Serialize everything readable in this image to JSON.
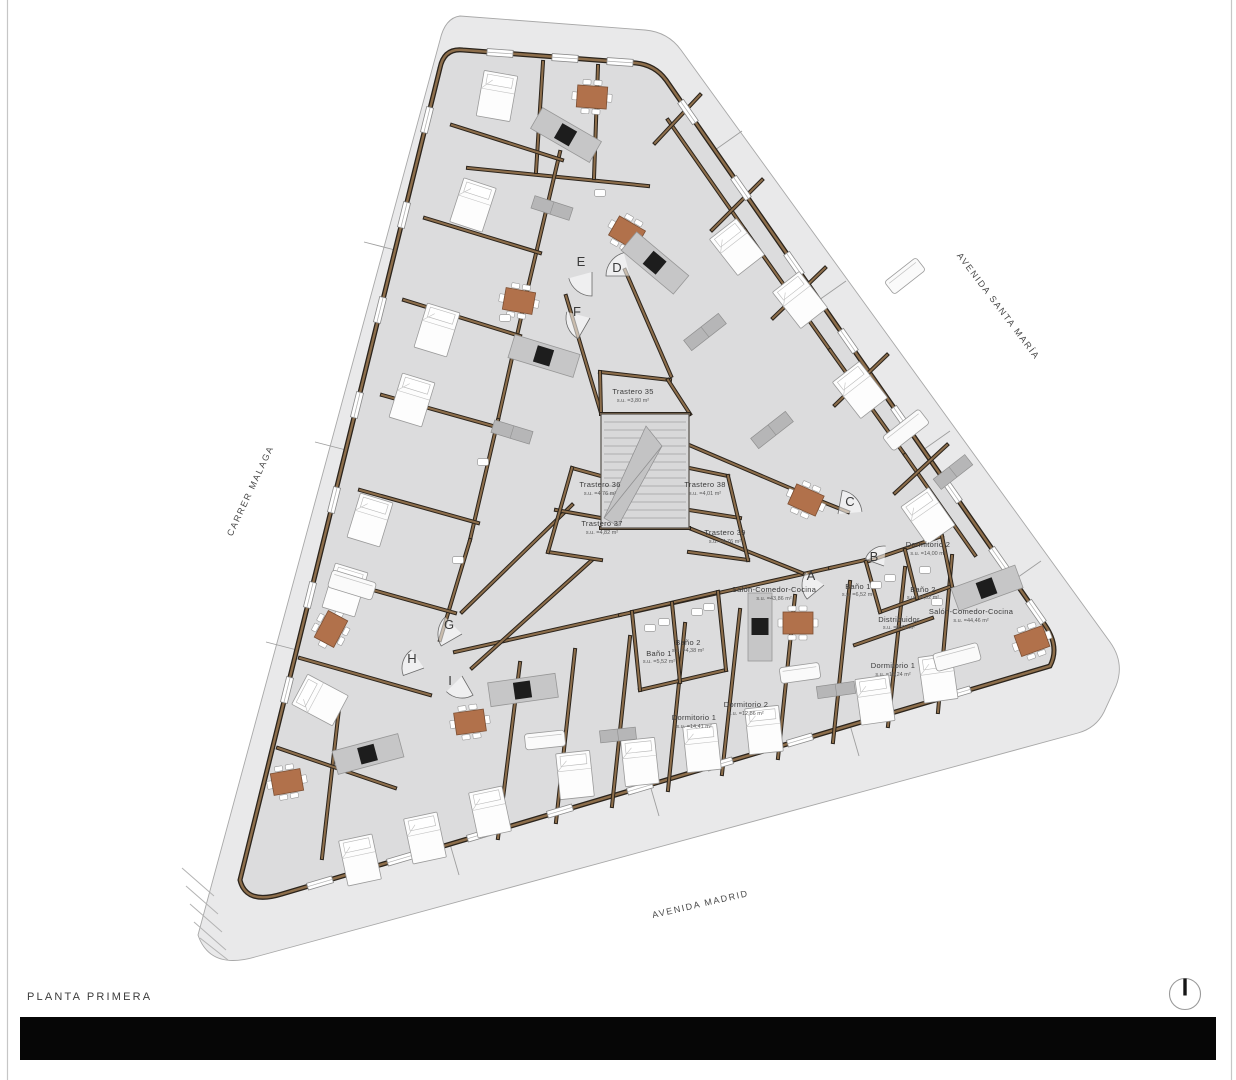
{
  "title": "PLANTA PRIMERA",
  "streets": {
    "left": "CARRER MALAGA",
    "right": "AVENIDA SANTA MARÍA",
    "bottom": "AVENIDA MADRID"
  },
  "entrances": [
    "A",
    "B",
    "C",
    "D",
    "E",
    "F",
    "G",
    "H",
    "I"
  ],
  "core": {
    "trasteros": [
      {
        "label": "Trastero 35",
        "area": "s.u. =3,80 m²"
      },
      {
        "label": "Trastero 36",
        "area": "s.u. =4,76 m²"
      },
      {
        "label": "Trastero 38",
        "area": "s.u. =4,01 m²"
      },
      {
        "label": "Trastero 37",
        "area": "s.u. =4,82 m²"
      },
      {
        "label": "Trastero 39",
        "area": "s.u. =4,76 m²"
      }
    ]
  },
  "apartment_a": {
    "rooms": [
      {
        "label": "Salón-Comedor-Cocina",
        "area": "s.u. =43,86 m²"
      },
      {
        "label": "Baño 1",
        "area": "s.u. =5,52 m²"
      },
      {
        "label": "Baño 2",
        "area": "s.u. =4,38 m²"
      },
      {
        "label": "Dormitorio 1",
        "area": "s.u. =14,41 m²"
      },
      {
        "label": "Dormitorio 2",
        "area": "s.u. =12,86 m²"
      }
    ]
  },
  "apartment_b": {
    "rooms": [
      {
        "label": "Dormitorio 2",
        "area": "s.u. =14,00 m²"
      },
      {
        "label": "Baño 1",
        "area": "s.u. =6,52 m²"
      },
      {
        "label": "Baño 2",
        "area": "s.u. =4,02 m²"
      },
      {
        "label": "Distribuidor",
        "area": "s.u. =5,79 m²"
      },
      {
        "label": "Salón-Comedor-Cocina",
        "area": "s.u. =44,46 m²"
      },
      {
        "label": "Dormitorio 1",
        "area": "s.u. =15,24 m²"
      }
    ]
  },
  "colors": {
    "floor": "#dcdcdd",
    "sidewalk": "#e9e9ea",
    "wall_brown": "#8d6e4b",
    "wall_dark": "#2b241c",
    "table_brown": "#b1714b",
    "title_bar": "#060606"
  }
}
